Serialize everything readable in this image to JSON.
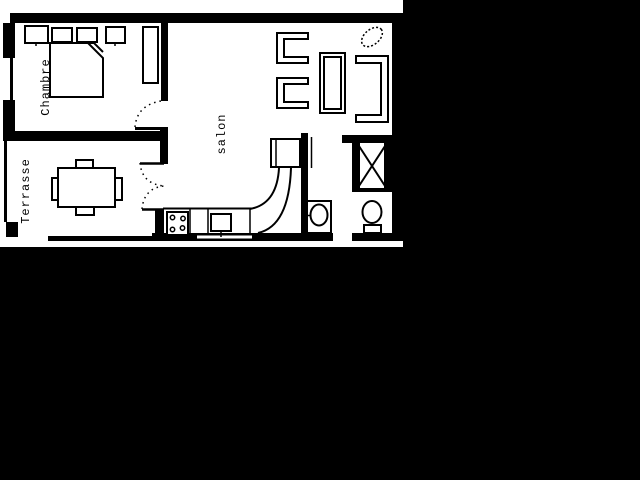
{
  "canvas": {
    "width": 640,
    "height": 480,
    "background_color": "#000000"
  },
  "floor_plan": {
    "width": 403,
    "height": 247,
    "floor_color": "#ffffff",
    "wall_color": "#000000",
    "labels": {
      "bedroom": "Chambre",
      "terrace": "Terrasse",
      "living_room": "salon"
    },
    "fixtures": [
      "bed",
      "pillow",
      "nightstand",
      "wardrobe",
      "dining-table",
      "dining-chair",
      "armchair",
      "coffee-table",
      "sofa",
      "plant",
      "fridge",
      "kitchen-counter",
      "stove",
      "kitchen-sink",
      "shower",
      "washbasin",
      "toilet",
      "door-swing",
      "double-door",
      "window"
    ]
  }
}
